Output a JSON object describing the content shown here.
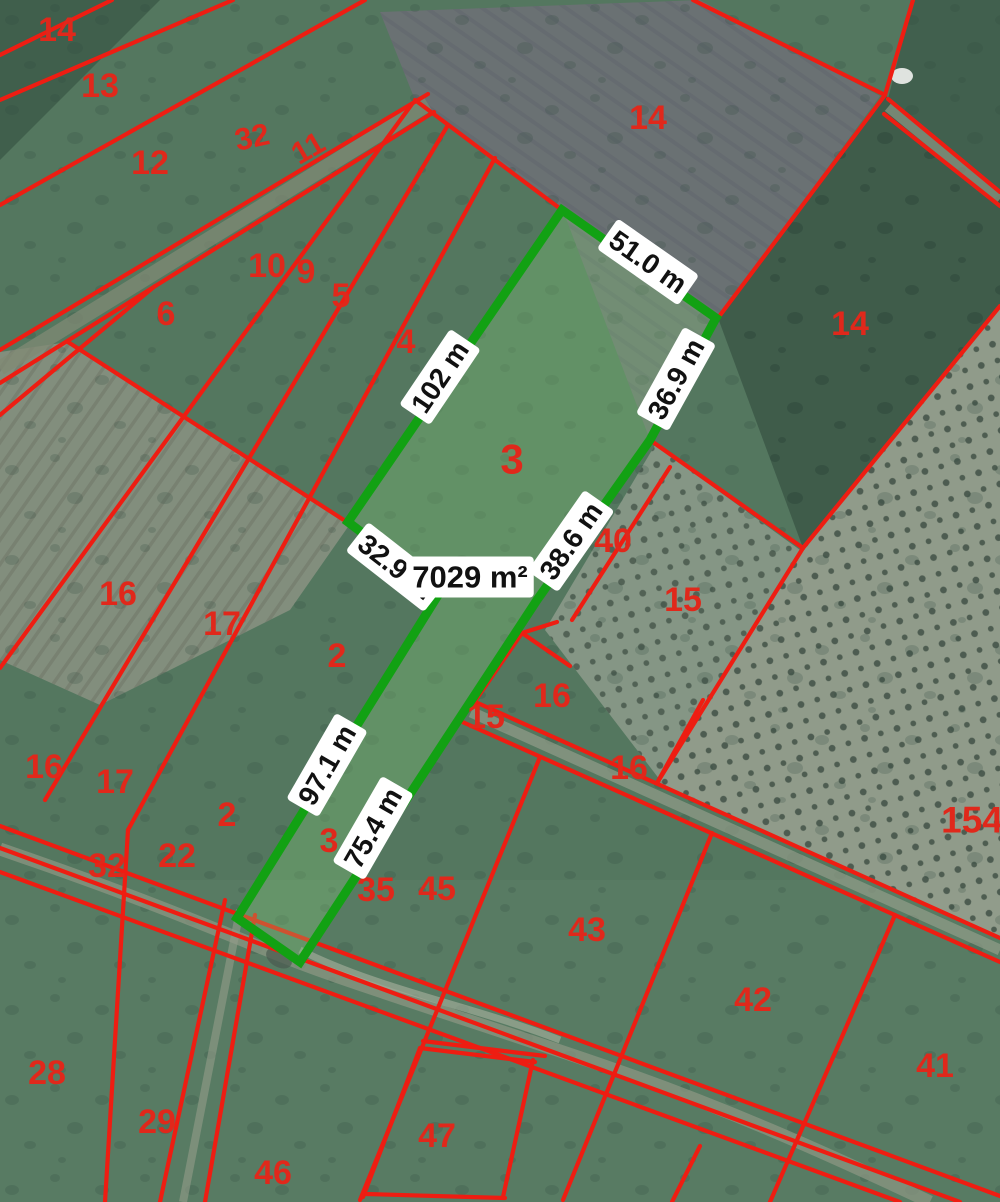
{
  "map": {
    "colors": {
      "parcel_line": "#ee1d12",
      "parcel_label": "#e0281b",
      "highlight_stroke": "#12a113",
      "highlight_fill": "rgba(132,206,120,0.30)",
      "measure_bg": "#ffffff",
      "measure_text": "#111111"
    },
    "highlighted_parcel": {
      "number": "3",
      "area_label": {
        "text": "7029 m²",
        "x": 470,
        "y": 577,
        "size": 31
      },
      "polygon": [
        [
          562,
          210
        ],
        [
          716,
          318
        ],
        [
          650,
          440
        ],
        [
          537,
          600
        ],
        [
          300,
          962
        ],
        [
          237,
          918
        ],
        [
          440,
          592
        ],
        [
          348,
          522
        ]
      ]
    },
    "measurements": [
      {
        "text": "51.0 m",
        "x": 648,
        "y": 262,
        "rot": 35,
        "size": 28
      },
      {
        "text": "102 m",
        "x": 440,
        "y": 377,
        "rot": -56,
        "size": 28
      },
      {
        "text": "36.9 m",
        "x": 676,
        "y": 379,
        "rot": -61,
        "size": 28
      },
      {
        "text": "38.6 m",
        "x": 571,
        "y": 541,
        "rot": -55,
        "size": 28
      },
      {
        "text": "32.9 m",
        "x": 396,
        "y": 567,
        "rot": 38,
        "size": 28
      },
      {
        "text": "97.1 m",
        "x": 327,
        "y": 765,
        "rot": -60,
        "size": 28
      },
      {
        "text": "75.4 m",
        "x": 373,
        "y": 828,
        "rot": -60,
        "size": 28
      }
    ],
    "parcel_labels": [
      {
        "text": "14",
        "x": 57,
        "y": 30
      },
      {
        "text": "13",
        "x": 100,
        "y": 86
      },
      {
        "text": "12",
        "x": 150,
        "y": 163
      },
      {
        "text": "32",
        "x": 252,
        "y": 137,
        "rot": -12,
        "size": 31
      },
      {
        "text": "11",
        "x": 308,
        "y": 148,
        "rot": -30,
        "size": 31
      },
      {
        "text": "10",
        "x": 267,
        "y": 266
      },
      {
        "text": "9",
        "x": 306,
        "y": 272
      },
      {
        "text": "5",
        "x": 341,
        "y": 296
      },
      {
        "text": "6",
        "x": 166,
        "y": 314
      },
      {
        "text": "4",
        "x": 406,
        "y": 342
      },
      {
        "text": "14",
        "x": 648,
        "y": 118
      },
      {
        "text": "14",
        "x": 850,
        "y": 324
      },
      {
        "text": "3",
        "x": 512,
        "y": 459,
        "size": 42
      },
      {
        "text": "40",
        "x": 613,
        "y": 541
      },
      {
        "text": "15",
        "x": 683,
        "y": 600
      },
      {
        "text": "16",
        "x": 118,
        "y": 594
      },
      {
        "text": "17",
        "x": 222,
        "y": 624
      },
      {
        "text": "2",
        "x": 337,
        "y": 656
      },
      {
        "text": "16",
        "x": 552,
        "y": 696
      },
      {
        "text": "15",
        "x": 486,
        "y": 717
      },
      {
        "text": "16",
        "x": 629,
        "y": 768
      },
      {
        "text": "16",
        "x": 44,
        "y": 767
      },
      {
        "text": "17",
        "x": 115,
        "y": 782
      },
      {
        "text": "2",
        "x": 227,
        "y": 815
      },
      {
        "text": "32",
        "x": 107,
        "y": 866
      },
      {
        "text": "22",
        "x": 177,
        "y": 856
      },
      {
        "text": "3",
        "x": 329,
        "y": 841
      },
      {
        "text": "35",
        "x": 376,
        "y": 890
      },
      {
        "text": "45",
        "x": 437,
        "y": 889
      },
      {
        "text": "43",
        "x": 587,
        "y": 930
      },
      {
        "text": "42",
        "x": 753,
        "y": 1000
      },
      {
        "text": "41",
        "x": 935,
        "y": 1066
      },
      {
        "text": "154",
        "x": 972,
        "y": 820,
        "size": 37
      },
      {
        "text": "28",
        "x": 47,
        "y": 1073
      },
      {
        "text": "29",
        "x": 157,
        "y": 1122
      },
      {
        "text": "46",
        "x": 273,
        "y": 1173
      },
      {
        "text": "47",
        "x": 437,
        "y": 1136
      }
    ],
    "boundary_lines": [
      [
        0,
        55,
        112,
        0
      ],
      [
        0,
        100,
        233,
        0
      ],
      [
        0,
        205,
        365,
        0
      ],
      [
        0,
        350,
        428,
        94
      ],
      [
        0,
        383,
        434,
        112
      ],
      [
        415,
        100,
        562,
        210
      ],
      [
        412,
        104,
        0,
        668
      ],
      [
        448,
        125,
        45,
        800
      ],
      [
        495,
        158,
        128,
        830
      ],
      [
        155,
        286,
        0,
        415
      ],
      [
        68,
        342,
        350,
        524
      ],
      [
        128,
        830,
        105,
        1202
      ],
      [
        225,
        900,
        160,
        1202
      ],
      [
        255,
        915,
        205,
        1202
      ],
      [
        0,
        826,
        1000,
        1196
      ],
      [
        0,
        848,
        960,
        1202
      ],
      [
        0,
        872,
        900,
        1202
      ],
      [
        420,
        1048,
        363,
        1197
      ],
      [
        423,
        1041,
        545,
        1056
      ],
      [
        420,
        1048,
        535,
        1062
      ],
      [
        533,
        1060,
        503,
        1197
      ],
      [
        366,
        1194,
        505,
        1198
      ],
      [
        540,
        757,
        360,
        1200
      ],
      [
        712,
        833,
        563,
        1200
      ],
      [
        895,
        915,
        770,
        1202
      ],
      [
        700,
        1146,
        672,
        1202
      ],
      [
        471,
        700,
        1000,
        938
      ],
      [
        458,
        720,
        1000,
        962
      ],
      [
        650,
        440,
        803,
        548
      ],
      [
        803,
        548,
        1000,
        306
      ],
      [
        803,
        548,
        657,
        783
      ],
      [
        703,
        700,
        657,
        783
      ],
      [
        670,
        467,
        572,
        620
      ],
      [
        557,
        622,
        522,
        633
      ],
      [
        522,
        633,
        570,
        666
      ],
      [
        522,
        633,
        473,
        704
      ],
      [
        693,
        0,
        885,
        95
      ],
      [
        913,
        0,
        885,
        95
      ],
      [
        885,
        95,
        718,
        318
      ],
      [
        888,
        99,
        1000,
        192
      ],
      [
        884,
        114,
        1000,
        206
      ]
    ]
  }
}
